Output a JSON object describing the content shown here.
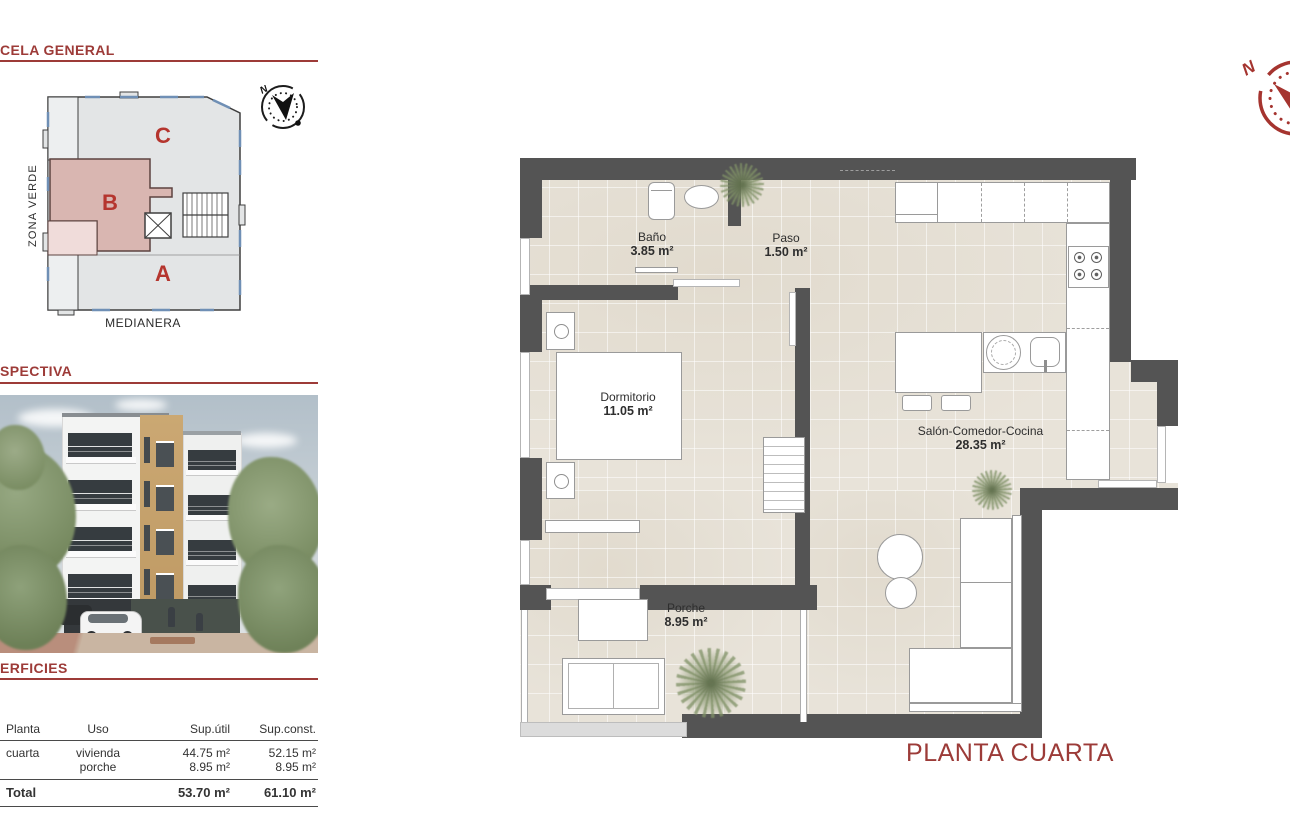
{
  "sidebar": {
    "parcela": {
      "heading": "CELA GENERAL",
      "block_a": "A",
      "block_b": "B",
      "block_c": "C",
      "zona_verde": "ZONA VERDE",
      "medianera": "MEDIANERA",
      "compass_n": "N"
    },
    "perspectiva": {
      "heading": "SPECTIVA"
    },
    "superficies": {
      "heading": "ERFICIES",
      "columns": [
        "Planta",
        "Uso",
        "Sup.útil",
        "Sup.const."
      ],
      "rows": [
        {
          "planta": "cuarta",
          "uso": "vivienda",
          "util": "44.75 m²",
          "const": "52.15 m²"
        },
        {
          "planta": "",
          "uso": "porche",
          "util": "8.95 m²",
          "const": "8.95 m²"
        }
      ],
      "total": {
        "label": "Total",
        "util": "53.70 m²",
        "const": "61.10 m²"
      }
    }
  },
  "plan": {
    "rooms": {
      "bano": {
        "name": "Baño",
        "area": "3.85 m²"
      },
      "paso": {
        "name": "Paso",
        "area": "1.50 m²"
      },
      "dormitorio": {
        "name": "Dormitorio",
        "area": "11.05 m²"
      },
      "salon": {
        "name": "Salón-Comedor-Cocina",
        "area": "28.35 m²"
      },
      "porche": {
        "name": "Porche",
        "area": "8.95 m²"
      }
    },
    "title": "PLANTA CUARTA",
    "compass_n": "N"
  },
  "colors": {
    "accent": "#9d3b38",
    "wall": "#545454",
    "floor": "#e8e3d9",
    "site_gray": "#e3e5e6",
    "site_pink": "#d9b6b1",
    "site_pink_light": "#f0dcda",
    "site_red": "#b5352e",
    "compass_red": "#a5342f"
  }
}
